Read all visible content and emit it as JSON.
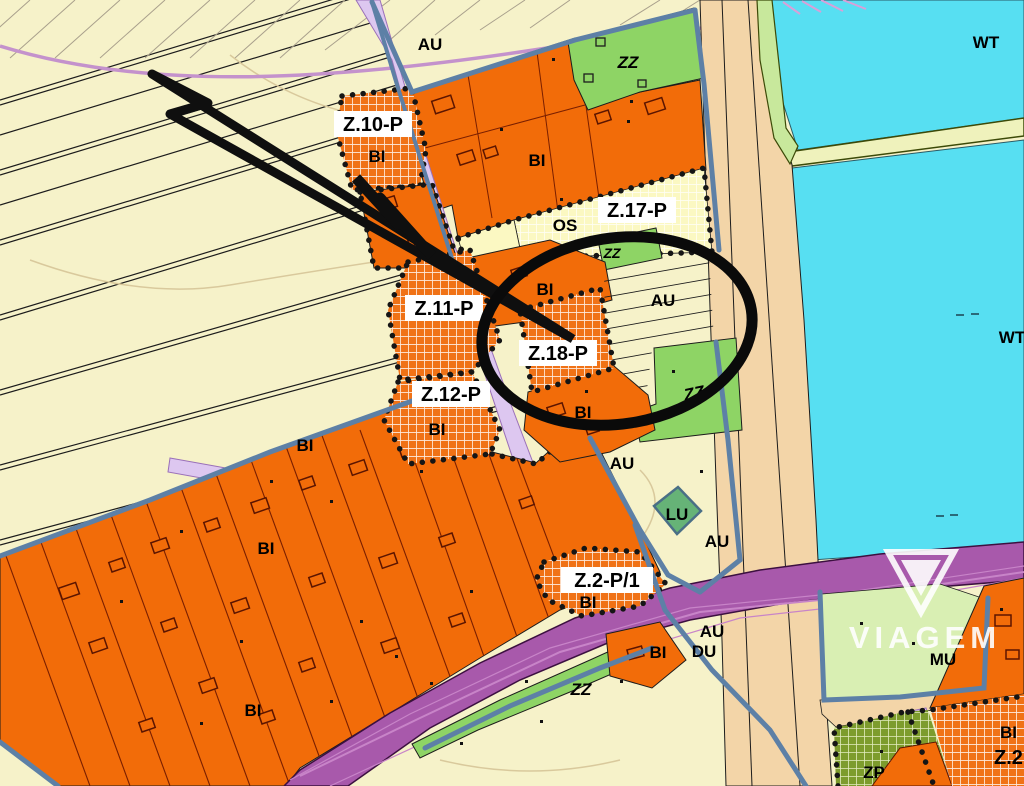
{
  "map_labels": {
    "au_top": "AU",
    "zz_top": "ZZ",
    "wt_top": "WT",
    "z10p": "Z.10-P",
    "bi_z10": "BI",
    "bi_top": "BI",
    "os": "OS",
    "z17p": "Z.17-P",
    "zz_mid": "ZZ",
    "bi_mid": "BI",
    "au_strips": "AU",
    "wt_right": "WT",
    "z11p": "Z.11-P",
    "z18p": "Z.18-P",
    "z12p": "Z.12-P",
    "bi_z12": "BI",
    "bi_below_z18": "BI",
    "zz_right": "ZZ",
    "bi_upper_mass": "BI",
    "au_center": "AU",
    "lu": "LU",
    "au_lower": "AU",
    "bi_mass": "BI",
    "z2p1": "Z.2-P/1",
    "bi_z2p1": "BI",
    "au_road": "AU",
    "du": "DU",
    "bi_small_right": "BI",
    "mu": "MU",
    "bi_bottom": "BI",
    "zz_bottom": "ZZ",
    "zp": "ZP",
    "bi_edge": "BI",
    "z2_edge": "Z.2"
  },
  "watermark": {
    "text": "VIAGEM"
  },
  "colors": {
    "background": "#f6f2c9",
    "residential_orange": "#f26c09",
    "development_hatch_orange": "#f07216",
    "green_zz": "#8ed465",
    "green_lu": "#66b377",
    "green_mu": "#d9efb3",
    "olive_zp": "#7d9c2d",
    "water_cyan": "#57dff2",
    "road_tan": "#f3d5a8",
    "road_purple": "#a859ab",
    "street_lavender": "#ddc7f0",
    "boundary_blue": "#5d80a6",
    "zone_yellow": "#fbf8c2",
    "parcel_line": "#7a1f00",
    "annotation_black": "#111111",
    "watermark_white": "#ffffff",
    "roadside_green": "#c8e89c",
    "strip_green": "#eff2bc",
    "curve_purple": "#c492cc"
  }
}
